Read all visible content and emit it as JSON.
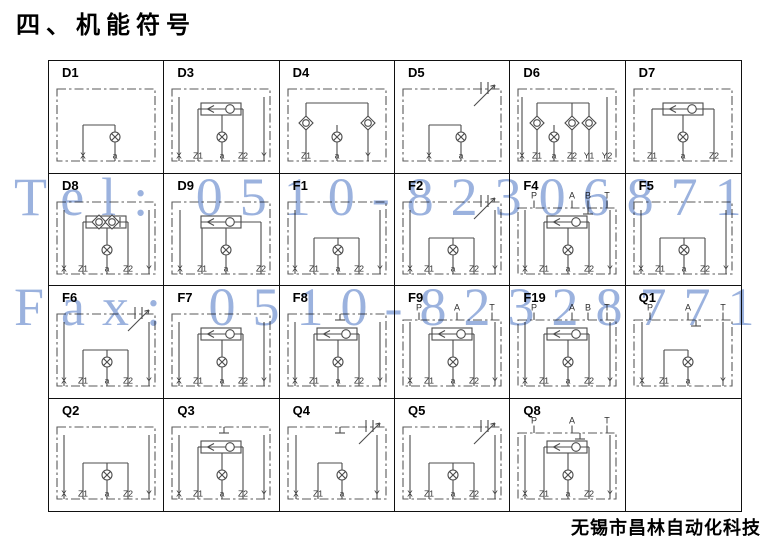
{
  "page": {
    "title": "四、机能符号",
    "company": "无锡市昌林自动化科技"
  },
  "watermark": {
    "line1": "Tel: 0510-82306871",
    "line2": "Fax: 0510-82328771",
    "color": "#8aa5d8"
  },
  "colors": {
    "diagram_line": "#4c4c4c",
    "grid_line": "#111111",
    "watermark_blue": "#8aa5d8",
    "text": "#000000"
  },
  "table": {
    "rows": 4,
    "cols": 6,
    "cells": [
      {
        "id": "D1",
        "top_ports": [],
        "bottom_ports": [
          "X",
          "a"
        ],
        "symbols": [
          "orifice"
        ]
      },
      {
        "id": "D3",
        "top_ports": [],
        "bottom_ports": [
          "X",
          "Z1",
          "a",
          "Z2",
          "Y"
        ],
        "symbols": [
          "shuttle-valve",
          "orifice"
        ]
      },
      {
        "id": "D4",
        "top_ports": [],
        "bottom_ports": [
          "Z1",
          "a",
          "Y"
        ],
        "symbols": [
          "check-valve",
          "check-valve",
          "orifice"
        ]
      },
      {
        "id": "D5",
        "top_ports": [],
        "bottom_ports": [
          "X",
          "a"
        ],
        "symbols": [
          "orifice",
          "adjustable-throttle"
        ]
      },
      {
        "id": "D6",
        "top_ports": [],
        "bottom_ports": [
          "X",
          "Z1",
          "a",
          "Z2",
          "Y1",
          "Y2"
        ],
        "symbols": [
          "check-valve",
          "check-valve",
          "check-valve",
          "orifice"
        ]
      },
      {
        "id": "D7",
        "top_ports": [],
        "bottom_ports": [
          "Z1",
          "a",
          "Z2"
        ],
        "symbols": [
          "shuttle-valve",
          "orifice"
        ]
      },
      {
        "id": "D8",
        "top_ports": [],
        "bottom_ports": [
          "X",
          "Z1",
          "a",
          "Z2",
          "Y"
        ],
        "symbols": [
          "double-check-valve",
          "orifice"
        ]
      },
      {
        "id": "D9",
        "top_ports": [],
        "bottom_ports": [
          "X",
          "Z1",
          "a",
          "Z2"
        ],
        "symbols": [
          "shuttle-valve",
          "orifice"
        ]
      },
      {
        "id": "F1",
        "top_ports": [],
        "bottom_ports": [
          "X",
          "Z1",
          "a",
          "Z2",
          "Y"
        ],
        "symbols": [
          "orifice"
        ]
      },
      {
        "id": "F2",
        "top_ports": [],
        "bottom_ports": [
          "X",
          "Z1",
          "a",
          "Z2",
          "Y"
        ],
        "symbols": [
          "orifice",
          "adjustable-throttle"
        ]
      },
      {
        "id": "F4",
        "top_ports": [
          "P",
          "A",
          "B",
          "T"
        ],
        "bottom_ports": [
          "X",
          "Z1",
          "a",
          "Z2",
          "Y"
        ],
        "symbols": [
          "shuttle-valve",
          "orifice",
          "tank"
        ]
      },
      {
        "id": "F5",
        "top_ports": [],
        "bottom_ports": [
          "X",
          "Z1",
          "a",
          "Z2",
          "Y"
        ],
        "symbols": [
          "orifice"
        ]
      },
      {
        "id": "F6",
        "top_ports": [],
        "bottom_ports": [
          "X",
          "Z1",
          "a",
          "Z2",
          "Y"
        ],
        "symbols": [
          "orifice",
          "adjustable-throttle"
        ]
      },
      {
        "id": "F7",
        "top_ports": [],
        "bottom_ports": [
          "X",
          "Z1",
          "a",
          "Z2",
          "Y"
        ],
        "symbols": [
          "shuttle-valve",
          "orifice"
        ]
      },
      {
        "id": "F8",
        "top_ports": [],
        "bottom_ports": [
          "X",
          "Z1",
          "a",
          "Z2",
          "Y"
        ],
        "symbols": [
          "shuttle-valve",
          "orifice",
          "tank"
        ]
      },
      {
        "id": "F9",
        "top_ports": [
          "P",
          "A",
          "T"
        ],
        "bottom_ports": [
          "X",
          "Z1",
          "a",
          "Z2",
          "Y"
        ],
        "symbols": [
          "shuttle-valve",
          "orifice"
        ]
      },
      {
        "id": "F19",
        "top_ports": [
          "P",
          "A",
          "B",
          "T"
        ],
        "bottom_ports": [
          "X",
          "Z1",
          "a",
          "Z2",
          "Y"
        ],
        "symbols": [
          "shuttle-valve",
          "orifice"
        ]
      },
      {
        "id": "Q1",
        "top_ports": [
          "P",
          "A",
          "T"
        ],
        "bottom_ports": [
          "X",
          "Z1",
          "a",
          "Y"
        ],
        "symbols": [
          "orifice",
          "tank"
        ]
      },
      {
        "id": "Q2",
        "top_ports": [],
        "bottom_ports": [
          "X",
          "Z1",
          "a",
          "Z2",
          "Y"
        ],
        "symbols": [
          "orifice"
        ]
      },
      {
        "id": "Q3",
        "top_ports": [],
        "bottom_ports": [
          "X",
          "Z1",
          "a",
          "Z2",
          "Y"
        ],
        "symbols": [
          "shuttle-valve",
          "orifice",
          "tank"
        ]
      },
      {
        "id": "Q4",
        "top_ports": [],
        "bottom_ports": [
          "X",
          "Z1",
          "a",
          "Y"
        ],
        "symbols": [
          "orifice",
          "adjustable-throttle",
          "tank"
        ]
      },
      {
        "id": "Q5",
        "top_ports": [],
        "bottom_ports": [
          "X",
          "Z1",
          "a",
          "Z2",
          "Y"
        ],
        "symbols": [
          "orifice",
          "adjustable-throttle"
        ]
      },
      {
        "id": "Q8",
        "top_ports": [
          "P",
          "A",
          "T"
        ],
        "bottom_ports": [
          "X",
          "Z1",
          "a",
          "Z2",
          "Y"
        ],
        "symbols": [
          "shuttle-valve",
          "orifice",
          "tank"
        ]
      },
      {
        "id": "",
        "top_ports": [],
        "bottom_ports": [],
        "symbols": []
      }
    ]
  }
}
